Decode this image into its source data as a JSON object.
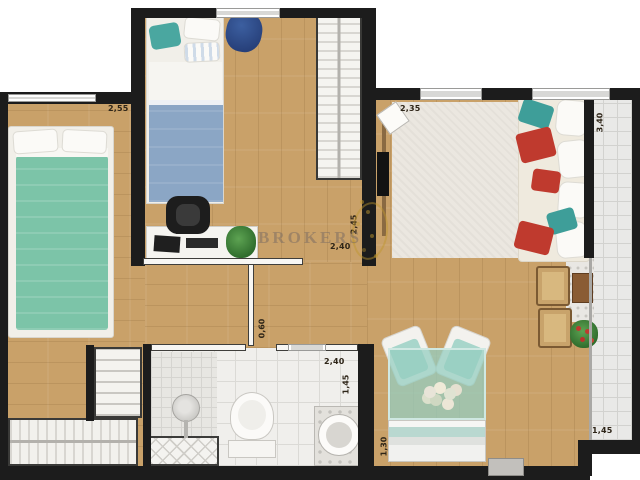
{
  "watermark": {
    "text": "BROKERS"
  },
  "labels": [
    {
      "id": "bedroom1-width",
      "text": "2,55",
      "orientation": "horizontal"
    },
    {
      "id": "living-width",
      "text": "2,35",
      "orientation": "horizontal"
    },
    {
      "id": "balcony-length",
      "text": "3,40",
      "orientation": "vertical"
    },
    {
      "id": "bedroom2-depth",
      "text": "2,45",
      "orientation": "vertical"
    },
    {
      "id": "bedroom2-width",
      "text": "2,40",
      "orientation": "horizontal"
    },
    {
      "id": "hall-door-width",
      "text": "0,60",
      "orientation": "vertical"
    },
    {
      "id": "bathroom-width",
      "text": "2,40",
      "orientation": "horizontal"
    },
    {
      "id": "bathroom-depth",
      "text": "1,45",
      "orientation": "vertical"
    },
    {
      "id": "dining-depth",
      "text": "1,30",
      "orientation": "vertical"
    },
    {
      "id": "balcony-width",
      "text": "1,45",
      "orientation": "horizontal"
    }
  ],
  "colors": {
    "wood": "#c9a169",
    "wall": "#1c1c1c",
    "tileLine": "#d2d2cf",
    "bedGreen": "#7cc4a8",
    "bedBlue": "#8ba6c5",
    "pillowRed": "#bf3a2e",
    "pillowTeal": "#3e9e99",
    "diningTeal": "#a8d6cb",
    "gold": "#be962d",
    "watermarkText": "#7d6e62"
  },
  "rooms": [
    {
      "name": "bedroom-1",
      "furniture": [
        "double-bed-green",
        "shelf-closet",
        "wardrobe-hanging"
      ]
    },
    {
      "name": "bedroom-2",
      "furniture": [
        "single-bed-blue",
        "beanbag",
        "wardrobe",
        "desk",
        "desk-chair",
        "plant"
      ]
    },
    {
      "name": "living-room",
      "furniture": [
        "rug",
        "tv-panel",
        "sofa-with-pillows",
        "wall-art"
      ]
    },
    {
      "name": "dining-area",
      "furniture": [
        "glass-table",
        "two-chairs",
        "bench-sofa",
        "flower-centerpiece"
      ]
    },
    {
      "name": "bathroom",
      "furniture": [
        "shower",
        "toilet",
        "round-sink"
      ]
    },
    {
      "name": "balcony",
      "furniture": [
        "two-wooden-chairs",
        "side-table",
        "plant"
      ]
    }
  ]
}
